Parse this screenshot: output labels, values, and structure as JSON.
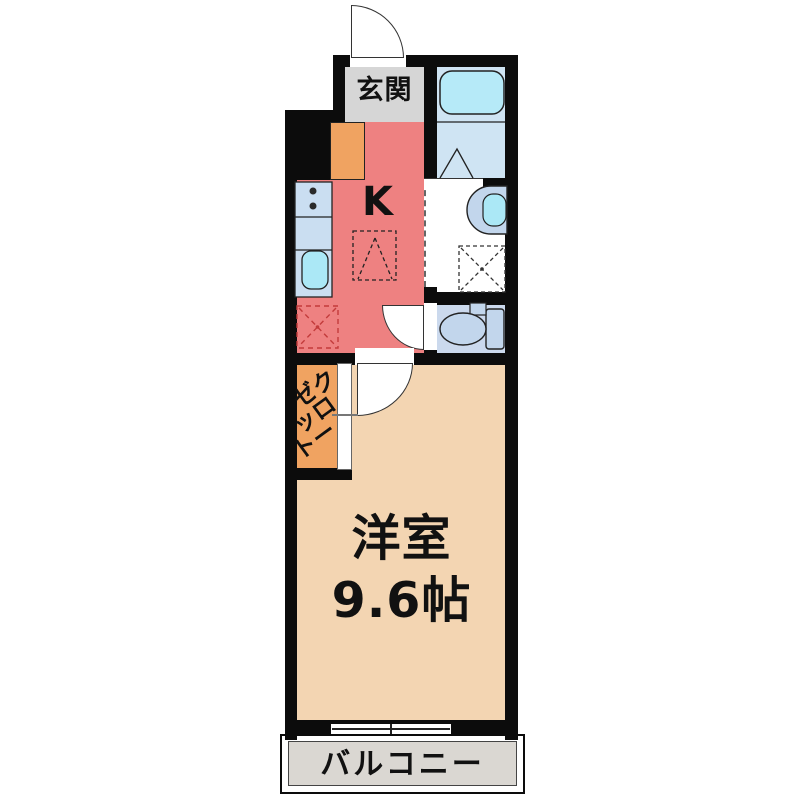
{
  "plan": {
    "rooms": {
      "genkan": {
        "label": "玄関"
      },
      "kitchen": {
        "label": "K"
      },
      "closet": {
        "label": "クローゼット",
        "column_right": "クロー",
        "column_left": "ゼット"
      },
      "western_room": {
        "name": "洋室",
        "size": "9.6帖"
      },
      "balcony": {
        "label": "バルコニー"
      }
    }
  },
  "colors": {
    "wall": "#0c0c0c",
    "line": "#222222",
    "door_line": "#333333",
    "kitchen": "#ee8181",
    "genkan": "#d6d6d6",
    "room": "#f3d5b2",
    "closet": "#f0a361",
    "bath": "#cfe4f3",
    "bathtub": "#b6eaf8",
    "toilet_room": "#cbd9ed",
    "fixture": "#c2d6ec",
    "counter": "#cadef1",
    "sink": "#abe8f6",
    "balcony": "#dad7d2",
    "space_red": "#c33b3b"
  }
}
